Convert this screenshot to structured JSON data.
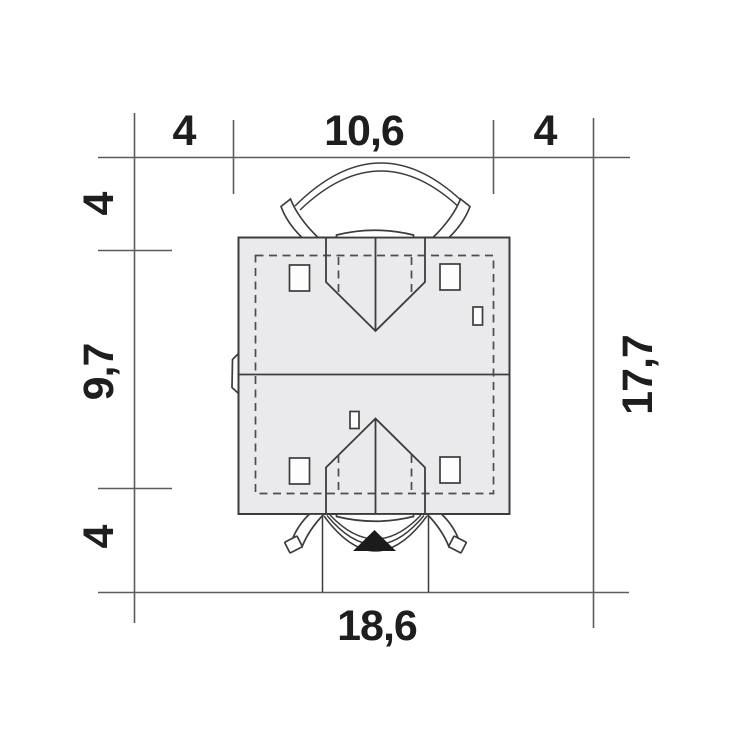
{
  "colors": {
    "background": "#ffffff",
    "drawing_line": "#3c3c3c",
    "dimension_line": "#5c5c5c",
    "dashed_line": "#4c4c4c",
    "label_text": "#1e1e1e",
    "roof_fill": "#eaeaec",
    "detail_fill": "#fdfdfd",
    "entrance_marker": "#1b1b1b"
  },
  "plan": {
    "dimensions_top": [
      {
        "label": "4"
      },
      {
        "label": "10,6"
      },
      {
        "label": "4"
      }
    ],
    "dimensions_left": [
      {
        "label": "4"
      },
      {
        "label": "9,7"
      },
      {
        "label": "4"
      }
    ],
    "dimensions_right": [
      {
        "label": "17,7"
      }
    ],
    "dimensions_bottom": [
      {
        "label": "18,6"
      }
    ]
  },
  "icons": {
    "entrance_marker": "filled-triangle-up"
  }
}
